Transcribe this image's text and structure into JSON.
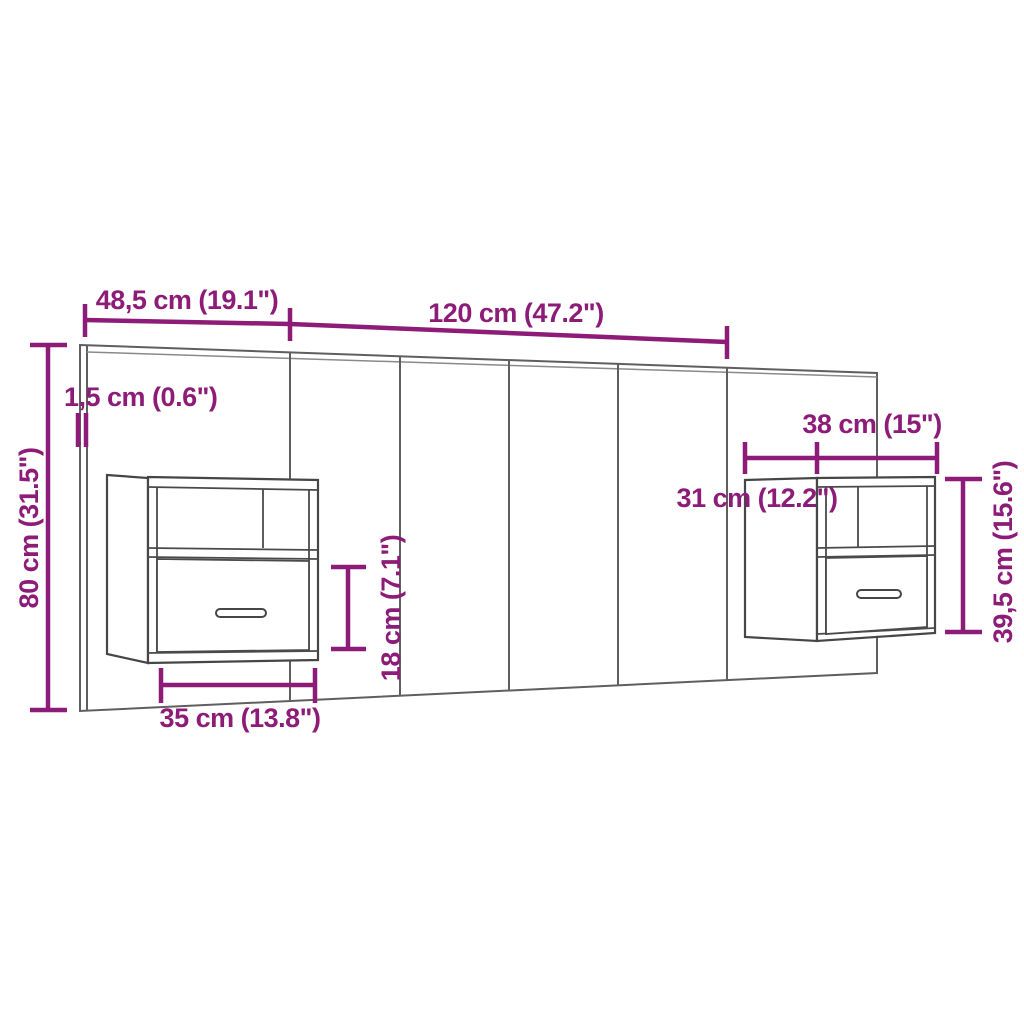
{
  "diagram": {
    "title": "headboard-with-wall-cabinets-dimension-diagram",
    "background_color": "#ffffff",
    "accent_color": "#8d1c78",
    "line_color": "#5f5f5f",
    "cabinet_line_color": "#464646",
    "labels": {
      "top_left_width": "48,5 cm (19.1\")",
      "top_middle_width": "120 cm (47.2\")",
      "panel_thickness": "1,5 cm (0.6\")",
      "headboard_height": "80 cm (31.5\")",
      "right_cabinet_width": "38 cm (15\")",
      "right_cabinet_depth": "31 cm (12.2\")",
      "right_cabinet_height": "39,5 cm (15.6\")",
      "drawer_section_height": "18 cm (7.1\")",
      "left_cabinet_width": "35 cm (13.8\")"
    }
  }
}
